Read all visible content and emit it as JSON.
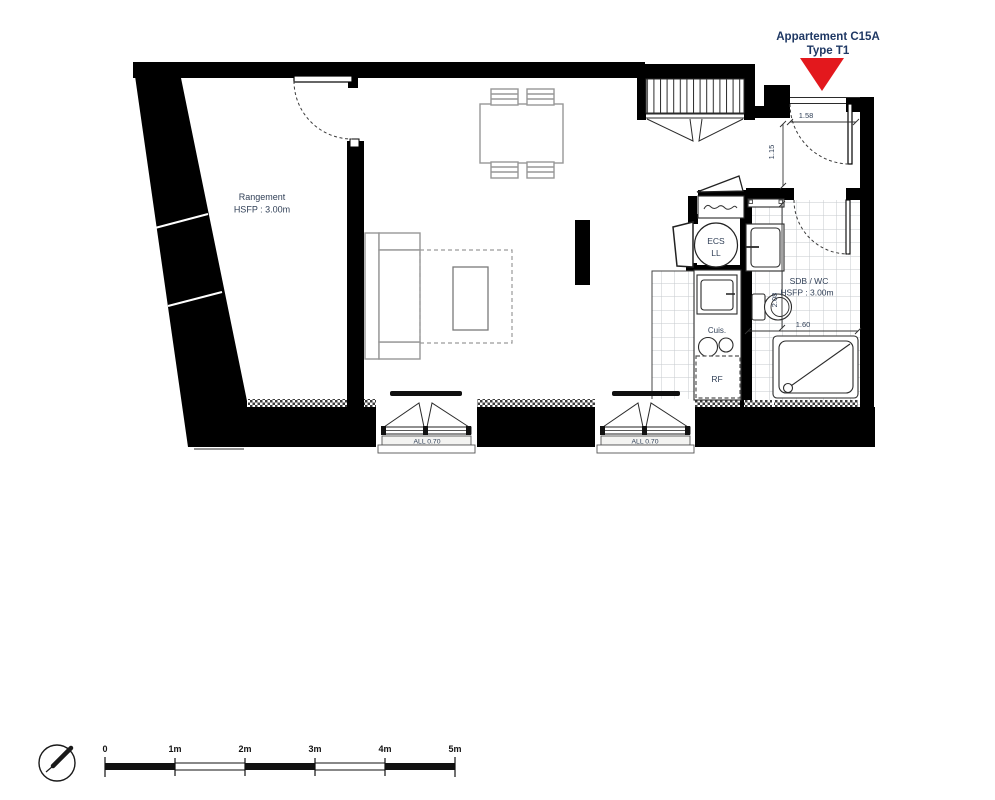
{
  "title": {
    "line1": "Appartement C15A",
    "line2": "Type T1"
  },
  "rooms": {
    "rangement": {
      "name": "Rangement",
      "height": "HSFP : 3.00m"
    },
    "sdb": {
      "name": "SDB / WC",
      "height": "HSFP : 3.00m"
    },
    "ecs": {
      "line1": "ECS",
      "line2": "LL"
    },
    "kitchen": {
      "cuisine": "Cuis.",
      "fridge": "RF"
    }
  },
  "dimensions": {
    "entry_width": "1.58",
    "entry_depth": "1.15",
    "sdb_depth": "2.08",
    "sdb_width": "1.60",
    "window_sill_1": "ALL 0.70",
    "window_sill_2": "ALL 0.70"
  },
  "scale_bar": {
    "labels": [
      "0",
      "1m",
      "2m",
      "3m",
      "4m",
      "5m"
    ]
  },
  "colors": {
    "marker_red": "#e3181d",
    "title_navy": "#1f3864",
    "label_navy": "#324158",
    "wall_black": "#000000"
  }
}
